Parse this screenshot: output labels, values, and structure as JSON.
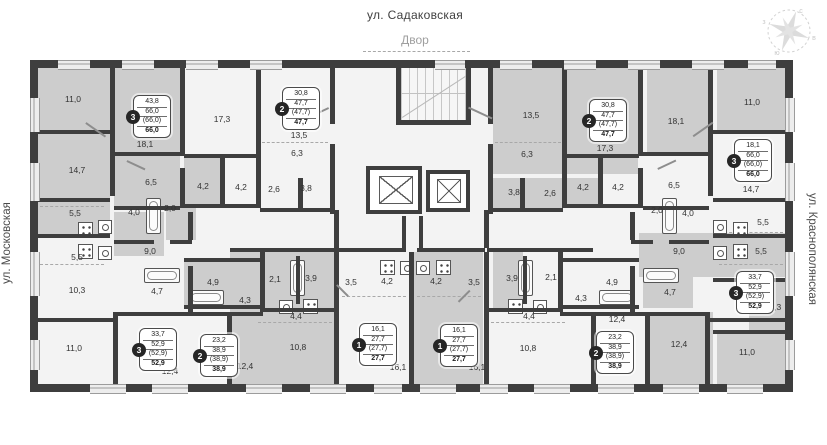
{
  "page": {
    "street_top": "ул. Садаковская",
    "courtyard": "Двор",
    "street_left": "ул. Московская",
    "street_right": "ул. Краснополянская"
  },
  "compass": {
    "n": "с",
    "e": "в",
    "s": "ю",
    "w": "з"
  },
  "rooms": [
    {
      "t": "11,0",
      "x": 73,
      "y": 99
    },
    {
      "t": "14,7",
      "x": 77,
      "y": 170
    },
    {
      "t": "18,1",
      "x": 145,
      "y": 144
    },
    {
      "t": "17,3",
      "x": 222,
      "y": 119
    },
    {
      "t": "6,5",
      "x": 151,
      "y": 182
    },
    {
      "t": "4,2",
      "x": 203,
      "y": 186
    },
    {
      "t": "4,2",
      "x": 241,
      "y": 187
    },
    {
      "t": "13,5",
      "x": 299,
      "y": 135
    },
    {
      "t": "6,3",
      "x": 297,
      "y": 153
    },
    {
      "t": "2,6",
      "x": 274,
      "y": 189
    },
    {
      "t": "3,8",
      "x": 306,
      "y": 188
    },
    {
      "t": "5,5",
      "x": 75,
      "y": 213
    },
    {
      "t": "4,0",
      "x": 134,
      "y": 212
    },
    {
      "t": "2,0",
      "x": 170,
      "y": 208
    },
    {
      "t": "5,5",
      "x": 77,
      "y": 257
    },
    {
      "t": "9,0",
      "x": 150,
      "y": 251
    },
    {
      "t": "10,3",
      "x": 77,
      "y": 290
    },
    {
      "t": "4,7",
      "x": 157,
      "y": 291
    },
    {
      "t": "4,9",
      "x": 213,
      "y": 282
    },
    {
      "t": "2,1",
      "x": 275,
      "y": 279
    },
    {
      "t": "3,9",
      "x": 311,
      "y": 278
    },
    {
      "t": "4,3",
      "x": 245,
      "y": 300
    },
    {
      "t": "4,4",
      "x": 296,
      "y": 316
    },
    {
      "t": "10,8",
      "x": 298,
      "y": 347
    },
    {
      "t": "12,4",
      "x": 245,
      "y": 366
    },
    {
      "t": "11,0",
      "x": 74,
      "y": 348
    },
    {
      "t": "12,4",
      "x": 170,
      "y": 371
    },
    {
      "t": "16,1",
      "x": 398,
      "y": 367
    },
    {
      "t": "3,5",
      "x": 351,
      "y": 282
    },
    {
      "t": "4,2",
      "x": 387,
      "y": 281
    },
    {
      "t": "4,2",
      "x": 436,
      "y": 281
    },
    {
      "t": "3,5",
      "x": 474,
      "y": 282
    },
    {
      "t": "16,1",
      "x": 477,
      "y": 367
    },
    {
      "t": "10,8",
      "x": 528,
      "y": 348
    },
    {
      "t": "3,9",
      "x": 512,
      "y": 278
    },
    {
      "t": "2,1",
      "x": 551,
      "y": 277
    },
    {
      "t": "4,9",
      "x": 612,
      "y": 282
    },
    {
      "t": "4,3",
      "x": 581,
      "y": 298
    },
    {
      "t": "4,4",
      "x": 529,
      "y": 316
    },
    {
      "t": "12,4",
      "x": 617,
      "y": 319
    },
    {
      "t": "13,5",
      "x": 531,
      "y": 115
    },
    {
      "t": "6,3",
      "x": 527,
      "y": 154
    },
    {
      "t": "17,3",
      "x": 605,
      "y": 148
    },
    {
      "t": "3,8",
      "x": 514,
      "y": 192
    },
    {
      "t": "2,6",
      "x": 550,
      "y": 193
    },
    {
      "t": "4,2",
      "x": 583,
      "y": 187
    },
    {
      "t": "4,2",
      "x": 618,
      "y": 187
    },
    {
      "t": "18,1",
      "x": 676,
      "y": 121
    },
    {
      "t": "11,0",
      "x": 752,
      "y": 102
    },
    {
      "t": "6,5",
      "x": 674,
      "y": 185
    },
    {
      "t": "14,7",
      "x": 751,
      "y": 189
    },
    {
      "t": "2,0",
      "x": 657,
      "y": 210
    },
    {
      "t": "4,0",
      "x": 688,
      "y": 213
    },
    {
      "t": "5,5",
      "x": 763,
      "y": 222
    },
    {
      "t": "9,0",
      "x": 679,
      "y": 251
    },
    {
      "t": "5,5",
      "x": 761,
      "y": 251
    },
    {
      "t": "4,7",
      "x": 670,
      "y": 292
    },
    {
      "t": "10,3",
      "x": 773,
      "y": 307
    },
    {
      "t": "12,4",
      "x": 679,
      "y": 344
    },
    {
      "t": "11,0",
      "x": 747,
      "y": 352
    }
  ],
  "apartments": [
    {
      "number": "3",
      "lines": [
        "43,8",
        "66,0",
        "(66,0)",
        "66,0"
      ],
      "x": 133,
      "y": 95
    },
    {
      "number": "2",
      "lines": [
        "30,8",
        "47,7",
        "(47,7)",
        "47,7"
      ],
      "x": 282,
      "y": 87
    },
    {
      "number": "1",
      "lines": [
        "16,1",
        "27,7",
        "(27,7)",
        "27,7"
      ],
      "x": 359,
      "y": 323
    },
    {
      "number": "1",
      "lines": [
        "16,1",
        "27,7",
        "(27,7)",
        "27,7"
      ],
      "x": 440,
      "y": 324
    },
    {
      "number": "3",
      "lines": [
        "33,7",
        "52,9",
        "(52,9)",
        "52,9"
      ],
      "x": 139,
      "y": 328
    },
    {
      "number": "2",
      "lines": [
        "23,2",
        "38,9",
        "(38,9)",
        "38,9"
      ],
      "x": 200,
      "y": 334
    },
    {
      "number": "2",
      "lines": [
        "30,8",
        "47,7",
        "(47,7)",
        "47,7"
      ],
      "x": 589,
      "y": 99
    },
    {
      "number": "3",
      "lines": [
        "18,1",
        "66,0",
        "(66,0)",
        "66,0"
      ],
      "x": 734,
      "y": 139
    },
    {
      "number": "3",
      "lines": [
        "33,7",
        "52,9",
        "(52,9)",
        "52,9"
      ],
      "x": 736,
      "y": 271
    },
    {
      "number": "2",
      "lines": [
        "23,2",
        "38,9",
        "(38,9)",
        "38,9"
      ],
      "x": 596,
      "y": 331
    }
  ]
}
